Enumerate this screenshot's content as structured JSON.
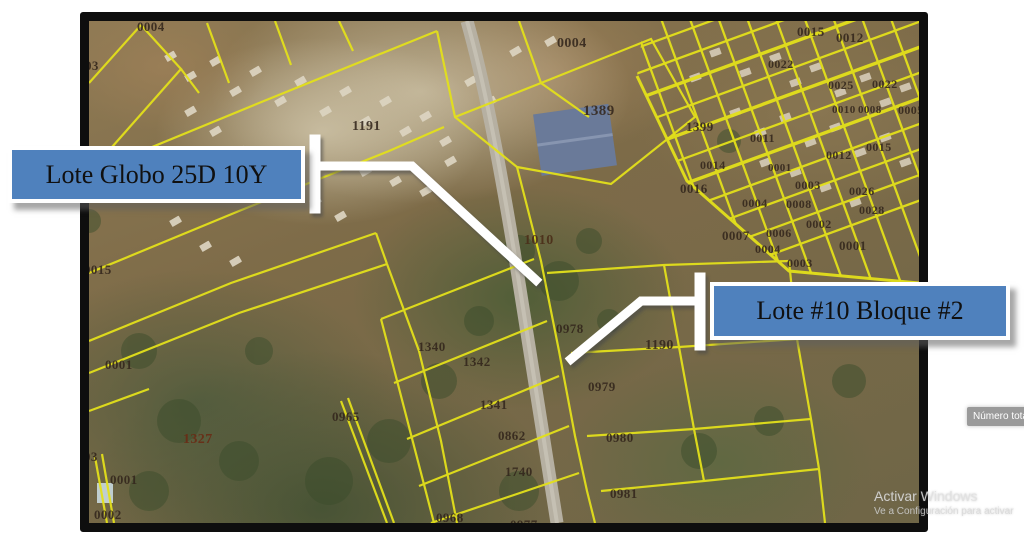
{
  "callouts": [
    {
      "id": "lote-globo",
      "label": "Lote Globo 25D 10Y"
    },
    {
      "id": "lote-10-bloque-2",
      "label": "Lote #10 Bloque #2"
    }
  ],
  "tooltip": {
    "text": "Número tota"
  },
  "watermark": {
    "line1": "Activar Windows",
    "line2": "Ve a Configuración para activar"
  },
  "colors": {
    "callout_fill": "#4f81bd",
    "parcel_line": "#e3e01b",
    "label_color": "#33261c",
    "road": "#b6b0a2",
    "warehouse": "#6a7a99"
  },
  "map": {
    "parcel_labels": [
      {
        "t": "0004",
        "x": 137,
        "y": 19
      },
      {
        "t": "03",
        "x": 85,
        "y": 58
      },
      {
        "t": "1191",
        "x": 352,
        "y": 119,
        "s": 14
      },
      {
        "t": "0004",
        "x": 557,
        "y": 36,
        "s": 14
      },
      {
        "t": "1389",
        "x": 583,
        "y": 103,
        "s": 15
      },
      {
        "t": "1399",
        "x": 686,
        "y": 119
      },
      {
        "t": "0015",
        "x": 797,
        "y": 24
      },
      {
        "t": "0012",
        "x": 836,
        "y": 30
      },
      {
        "t": "0022",
        "x": 768,
        "y": 57,
        "s": 12
      },
      {
        "t": "0025",
        "x": 828,
        "y": 78,
        "s": 12
      },
      {
        "t": "0022",
        "x": 872,
        "y": 77,
        "s": 12
      },
      {
        "t": "0010",
        "x": 832,
        "y": 104,
        "s": 11
      },
      {
        "t": "0008",
        "x": 858,
        "y": 104,
        "s": 11
      },
      {
        "t": "0005",
        "x": 898,
        "y": 103,
        "s": 12
      },
      {
        "t": "0011",
        "x": 750,
        "y": 131,
        "s": 12
      },
      {
        "t": "0012",
        "x": 826,
        "y": 148,
        "s": 12
      },
      {
        "t": "0015",
        "x": 866,
        "y": 140,
        "s": 12
      },
      {
        "t": "0014",
        "x": 700,
        "y": 158,
        "s": 12
      },
      {
        "t": "0001",
        "x": 768,
        "y": 162,
        "s": 11
      },
      {
        "t": "0016",
        "x": 680,
        "y": 181,
        "s": 13
      },
      {
        "t": "0003",
        "x": 795,
        "y": 178,
        "s": 12
      },
      {
        "t": "0026",
        "x": 849,
        "y": 184,
        "s": 12
      },
      {
        "t": "0004",
        "x": 742,
        "y": 196,
        "s": 12
      },
      {
        "t": "0008",
        "x": 786,
        "y": 197,
        "s": 12
      },
      {
        "t": "0028",
        "x": 859,
        "y": 203,
        "s": 12
      },
      {
        "t": "0002",
        "x": 806,
        "y": 217,
        "s": 12
      },
      {
        "t": "0007",
        "x": 722,
        "y": 228
      },
      {
        "t": "0006",
        "x": 766,
        "y": 226,
        "s": 12
      },
      {
        "t": "0004",
        "x": 755,
        "y": 242,
        "s": 12
      },
      {
        "t": "0001",
        "x": 839,
        "y": 238
      },
      {
        "t": "0003",
        "x": 787,
        "y": 256,
        "s": 12
      },
      {
        "t": "0015",
        "x": 84,
        "y": 262
      },
      {
        "t": "0001",
        "x": 105,
        "y": 357
      },
      {
        "t": "1010",
        "x": 524,
        "y": 233,
        "s": 14,
        "c": "#4a2d18"
      },
      {
        "t": "0978",
        "x": 556,
        "y": 321
      },
      {
        "t": "1190",
        "x": 645,
        "y": 338,
        "s": 14
      },
      {
        "t": "1340",
        "x": 418,
        "y": 339
      },
      {
        "t": "1342",
        "x": 463,
        "y": 354
      },
      {
        "t": "0965",
        "x": 332,
        "y": 409
      },
      {
        "t": "0979",
        "x": 588,
        "y": 379
      },
      {
        "t": "1341",
        "x": 480,
        "y": 397
      },
      {
        "t": "0862",
        "x": 498,
        "y": 428
      },
      {
        "t": "0980",
        "x": 606,
        "y": 430
      },
      {
        "t": "1740",
        "x": 505,
        "y": 464
      },
      {
        "t": "0981",
        "x": 610,
        "y": 486
      },
      {
        "t": "0968",
        "x": 436,
        "y": 510
      },
      {
        "t": "0977",
        "x": 510,
        "y": 517
      },
      {
        "t": "1327",
        "x": 183,
        "y": 432,
        "s": 14,
        "c": "#6a2a14"
      },
      {
        "t": "03",
        "x": 84,
        "y": 449
      },
      {
        "t": "0001",
        "x": 110,
        "y": 472
      },
      {
        "t": "0002",
        "x": 94,
        "y": 507
      }
    ]
  }
}
